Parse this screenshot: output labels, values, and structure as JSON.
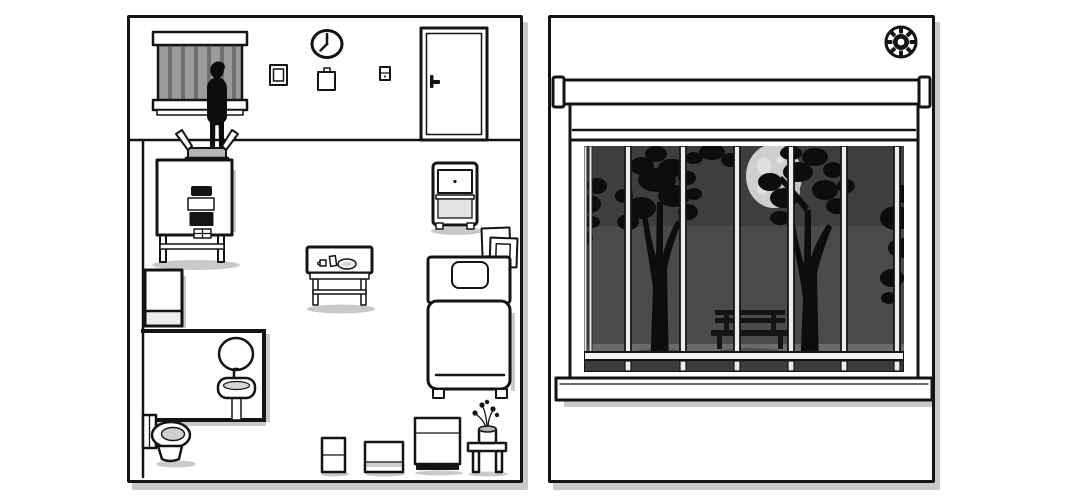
{
  "scene": {
    "description": "black-and-white point-and-click game room map beside a barred night window view",
    "panels": [
      "room-cutaway-map",
      "window-view"
    ]
  },
  "colors": {
    "ink": "#141414",
    "paper": "#ffffff",
    "shadow": "#c9c9c9",
    "glass": "#9b9b9b",
    "glass_bar": "#6f6f6f",
    "box_gray": "#b5b5b5",
    "sky_top": "#3e3e3e",
    "sky_mid": "#4b4b4b",
    "ground": "#6b6b6b",
    "ground_shadow": "#4f4f4f",
    "moon": "#cecece",
    "moon_spot": "#e0e0e0",
    "moon_shade": "#c0c0c0",
    "bar_fill": "#ededed",
    "silhouette": "#0d0d0d",
    "bench": "#141414",
    "shelf": "#e3e3e3",
    "inner_gray": "#d6d6d6"
  },
  "left_panel": {
    "name": "room-cutaway-map",
    "clock": {
      "approx_time": "8:00",
      "hour_hand": "pointing to 8",
      "minute_hand": "pointing to 12"
    },
    "wall_items": [
      "barred-window",
      "wall-clock",
      "small-picture-frame",
      "wall-notepad",
      "light-switch",
      "door"
    ],
    "figures": [
      "standing-person-silhouette-on-box"
    ],
    "furniture": [
      "open-box",
      "appliance-stand",
      "rolling-cart",
      "tilted-picture-frames",
      "bed-with-pillow",
      "side-table-with-cup-card-plate",
      "tall-cabinet",
      "bathroom-mirror",
      "pedestal-sink",
      "toilet",
      "small-box",
      "flat-box",
      "storage-box",
      "plant-stool"
    ]
  },
  "right_panel": {
    "name": "window-view",
    "settings_icon": "gear",
    "window": {
      "blind": "rolled up at top",
      "bars_count": 6,
      "scene": {
        "time_of_day": "night",
        "moon": true,
        "trees": 2,
        "bench": true,
        "ground": "park lawn"
      }
    }
  }
}
